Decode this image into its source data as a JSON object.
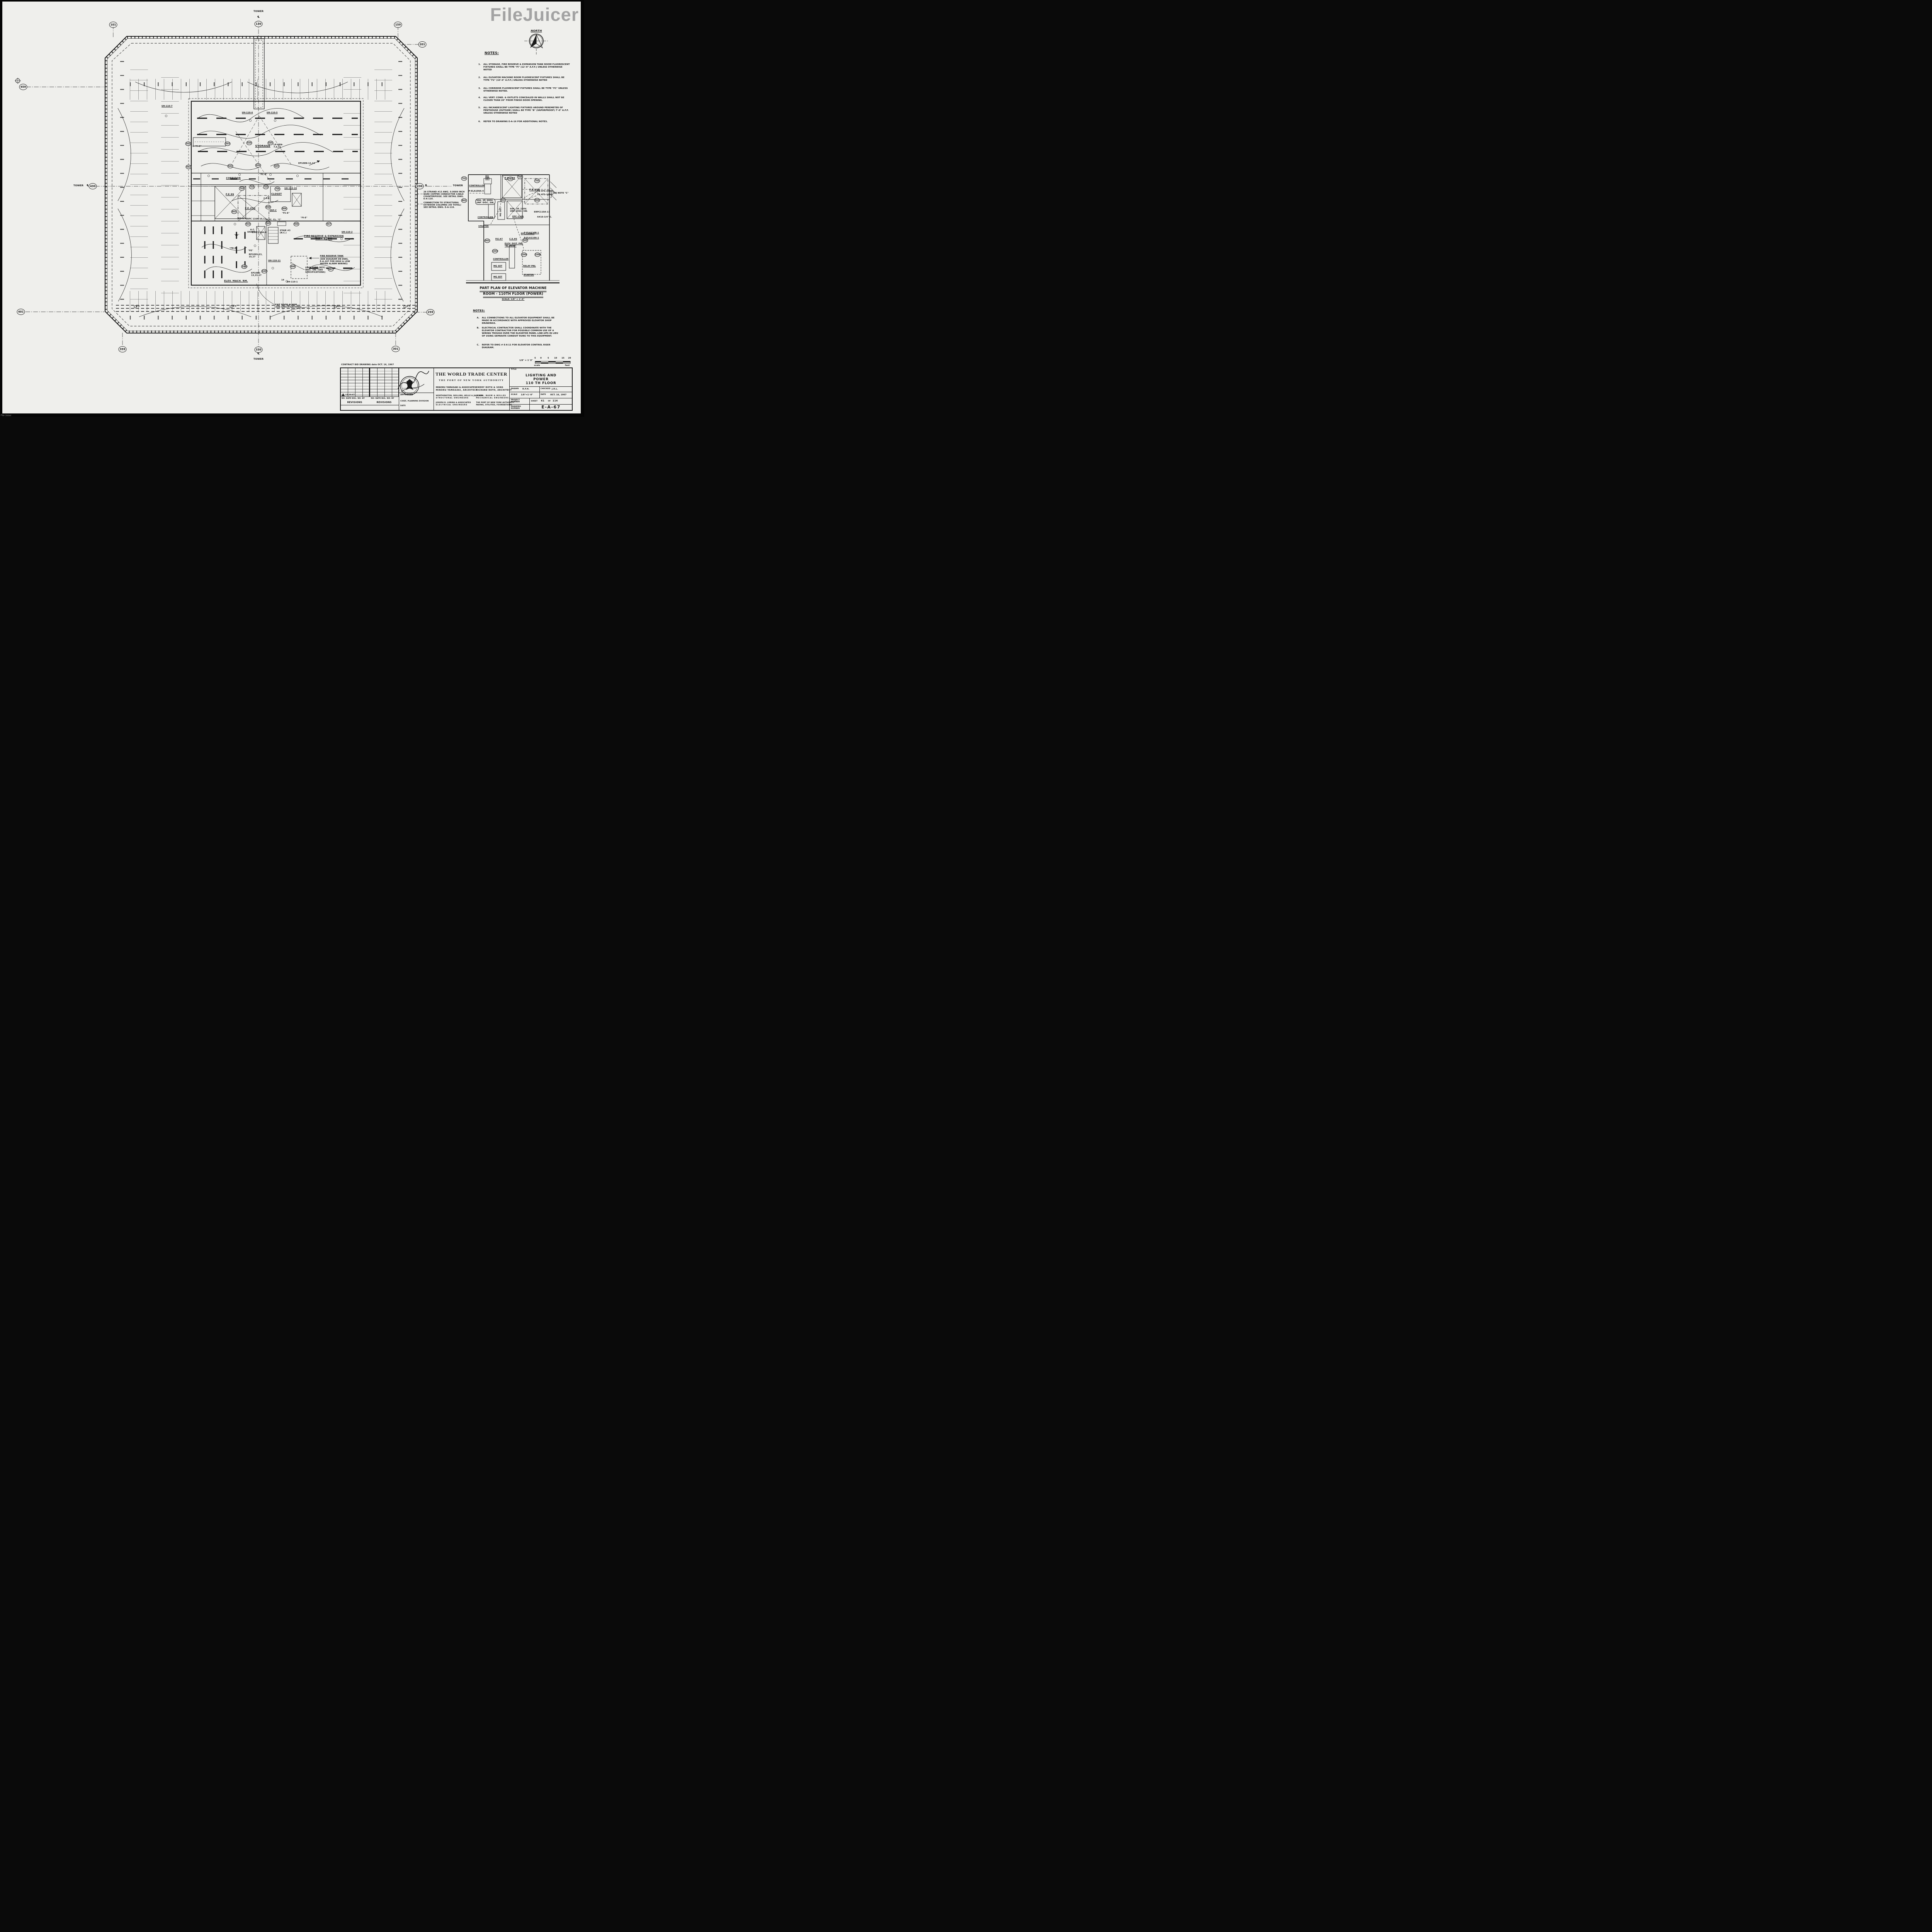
{
  "watermark": {
    "brand": "FileJuicer",
    "corner": "File Juicer"
  },
  "compass": {
    "label": "NORTH"
  },
  "grid": {
    "n1": "101",
    "n2": "130",
    "n3": "159",
    "e1": "201",
    "e2": "230",
    "e3": "259",
    "s1": "301",
    "s2": "330",
    "s3": "359",
    "w1": "401",
    "w2": "430",
    "w3": "459",
    "tower": "TOWER",
    "cl": "℄"
  },
  "notes": {
    "title": "NOTES:",
    "items": [
      {
        "n": "1.",
        "t": "ALL STORAGE, FIRE RESERVE & EXPANSION TANK ROOM FLUORESCENT FIXTURES SHALL BE TYPE \"FI\" (12'-0\" A.F.F.) UNLESS OTHERWISE NOTED"
      },
      {
        "n": "2.",
        "t": "ALL ELEVATOR MACHINE ROOM FLUORESCENT FIXTURES SHALL BE TYPE \"F2\" (10'-0\" A.F.F.) UNLESS OTHERWISE NOTED"
      },
      {
        "n": "3.",
        "t": "ALL CORRIDOR FLUORESCENT FIXTURES SHALL BE TYPE \"FC\" UNLESS OTHERWISE NOTED."
      },
      {
        "n": "4.",
        "t": "ALL VERT. COND. & OUTLETS CONCEALED IN WALLS SHALL NOT BE CLOSER THAN 20\" FROM FINISH DOOR OPENING."
      },
      {
        "n": "5.",
        "t": "ALL INCANDESCENT LIGHTING FIXTURES AROUND PEREMETER OF PENTHOUSE (OUTSIDE) SHALL BE TYPE \"B\" (VAPORPROOF) 7'-0\" A.F.F. UNLESS OTHERWISE NOTED"
      },
      {
        "n": "6.",
        "t": "REFER TO DRAWING E-A-16 FOR ADDITIONAL NOTES."
      }
    ]
  },
  "plan": {
    "rooms": {
      "storage": "STORAGE",
      "corridor": "CORRIDOR",
      "fe99": "F.E.99",
      "fe50": "F.E.#50",
      "closet": "CLOSET",
      "elec_cl": "ELEC. CL. \"C\"",
      "stair": "STAIR #3\n(N.C.)",
      "ac_shaft": "A.C.\nSHAFT",
      "elev_mach": "ELEV. MACH. RM.",
      "tank": "FIRE RESERVE & EXPANSION\nTANK ROOM"
    },
    "equip": {
      "uh7": "UH-110-7",
      "uh6": "UH-110-6",
      "uh5": "UH-110-5",
      "uh2": "UH-110-2",
      "uh11": "UH-110-11",
      "uh1": "UH-110-1",
      "uh10": "UH-110-10",
      "ep108n": "EP108N-12,14",
      "lpgen": "LP-GEN-\n7,9,11",
      "rp109s": "RP109S-13,\n15,17",
      "ep108s": "EP108S-\n13,15,17",
      "erpc1012": "ERPC 110A-10,12",
      "erpc9": "ERPC110A-9",
      "cpb": "C.P.B.",
      "erpc": "ERP-C",
      "fi2": "2-\"FI-E\"",
      "fce": "\"FC-E\"",
      "fde": "\"FD-E\"",
      "fie": "\"FI-E\"",
      "fe": "\"FE\"",
      "vt": "V.T.",
      "fourteen": "14",
      "uh": "UH"
    },
    "callouts": {
      "counterpoise": "28 STRAND #13 AWG. 0.0689 INCH\nBARE COPPER CONDUCTOR CABLE\nCOUNTERPOISE. SEE DETAIL DWG. E-A-119.",
      "columns": "CONNECTION TO STRUCTURAL\nEXTERIOR COLUMNS (40 TOTAL)\nSEE DETAIL DWG. E-A-119.",
      "tank_title": "FIRE RESERVE TANK",
      "tank_body": "(SEE DIAGRAM ON DWG.\nE-A-107 FOR HIGH & LOW\nWATER ALARM WIRING)",
      "lock": "LOCK TYPE (KEY)\nDISC. SW. (SEE\nSPECIFICATIONS)",
      "exit": "EXIT DOOR ALARM\n(SEE SPECIFICATIONS)"
    },
    "bubbles": [
      "502",
      "503",
      "504",
      "505",
      "602",
      "603",
      "604",
      "605",
      "703",
      "704",
      "705",
      "706",
      "803",
      "804",
      "806",
      "903",
      "905",
      "906",
      "907",
      "1003",
      "1005",
      "606",
      "607"
    ]
  },
  "part_plan": {
    "title1": "PART PLAN OF ELEVATOR MACHINE",
    "title2": "ROOM - 110TH FLOOR (POWER)",
    "scale": "SCALE: 1/8\" = 1'-0\"",
    "notes_title": "NOTES:",
    "notes": [
      {
        "n": "A.",
        "t": "ALL CONNECTIONS TO ALL ELEVATOR EQUIPMENT SHALL BE MADE IN ACCORDANCE WITH APPROVED ELEVATOR SHOP DRAWINGS."
      },
      {
        "n": "B.",
        "t": "ELECTRICAL CONTRACTOR SHALL COORDINATE WITH THE ELEVATOR CONTRACTOR FOR POSSIBLE COMMON USE OF A WIRING TROUGH OVER THE ELEVATOR PANEL LINE-UPS IN LIEU OF USING SEPARATE CONDUIT RUNS TO THIS EQUIPMENT."
      },
      {
        "n": "C.",
        "t": "REFER TO DWG # E-X-11 FOR ELEVATOR CONTROL RISER DIAGRAM."
      }
    ],
    "labels": {
      "mg_set": "MG\nSET",
      "controller": "CONTROLLER",
      "p_ela109a4": "P-ELA109A-4",
      "sw600": "60A, 3P, 600V.\nUNF. DISC. SW.",
      "fe99": "F.E.#99",
      "fe50": "F.E.#50",
      "ats_nl": "TO ATS-108NL",
      "ats_sl": "TO ATS-108SL",
      "see_note": "SEE NOTE \"C\"",
      "sw230": "60A, 3P, 230V.\nUNF. DISC. SW.",
      "epc110a": "EPC-110A",
      "erpc13": "ERPC110A-13",
      "conduit": "4#10-3/4\" C.",
      "controller2": "CONTROLLER",
      "starter": "STARTER",
      "mg_v": "MG SET.",
      "epc110a3": "EPC 110A-3",
      "elev_dist": "ELEV. DIST. PNL\n\"EL-A110\"",
      "pe7": "P.E.#7",
      "ce6": "C.E.#6",
      "pb1": "P-ELA110B-1",
      "pa1": "P-ELA110A-1",
      "controller3": "CONTROLLER",
      "mg2": "MG SET",
      "mg3": "MG SET",
      "relay": "RELAY PNL",
      "starter2": "STARTER"
    },
    "bubbles": [
      "702",
      "802",
      "703",
      "704",
      "705",
      "803",
      "804",
      "903",
      "905",
      "1003",
      "1004",
      "1009"
    ]
  },
  "scalebar": {
    "ratio": "1/8\" = 1' 0\"",
    "ticks": [
      "5",
      "0",
      "5",
      "10",
      "15",
      "20"
    ],
    "unit_left": "scale",
    "unit_right": "feet"
  },
  "titleblock": {
    "contract": "CONTRACT  BID  DRAWING   date  OCT. 16, 1967",
    "rev_header": "NO.   DATE   BUL. NO.   BY",
    "revisions": "REVISIONS",
    "rev_mark": "12·18·67",
    "approved": "APPROVED",
    "chief": "CHIEF, PLANNING DIVISION",
    "date_word": "DATE",
    "project": "THE WORLD TRADE CENTER",
    "authority": "THE PORT OF NEW YORK AUTHORITY",
    "firm1a": "MINORU YAMASAKI & ASSOCIATES",
    "firm1b": "MINORU YAMASAKI, ARCHITECT",
    "firm2a": "EMERY ROTH & SONS",
    "firm2b": "RICHARD ROTH, ARCHITECT",
    "firm3a": "WORTHINGTON, SKILLING, HELLE & JACKSON",
    "firm3b": "STRUCTURAL ENGINEERS",
    "firm4a": "JAROS, BAUM & BOLLES",
    "firm4b": "MECHANICAL ENGINEERS",
    "firm5a": "JOSEPH R. LORING & ASSOCIATES",
    "firm5b": "ELECTRICAL ENGINEERS",
    "firm6a": "THE PORT OF NEW YORK AUTHORITY",
    "firm6b": "PAVING, UTILITIES, FOUNDATIONS",
    "title_lbl": "TITLE",
    "sheet_title": "LIGHTING AND POWER\n110 TH FLOOR",
    "drawn_lbl": "DRAWN",
    "drawn": "R.F.H.",
    "checked_lbl": "CHECKED",
    "checked": "J.R.L.",
    "scale_lbl": "SCALE",
    "scale_val": "1/8\"=1'-0\"",
    "date_lbl": "DATE",
    "date_val": "OCT. 16, 1967",
    "project_lbl": "PROJECT\nNUMBER",
    "sheet_lbl": "SHEET",
    "sheet_no": "61",
    "of_lbl": "OF",
    "sheet_total": "114",
    "dwgno_lbl": "DRAWING\nNUMBER",
    "dwg_no": "E-A-67",
    "seal_line1": "LICENSED PROFESSIONAL ENGINEER",
    "seal_line2": "JOSEPH R. LORING",
    "seal_line3": "STATE OF NEW YORK"
  }
}
